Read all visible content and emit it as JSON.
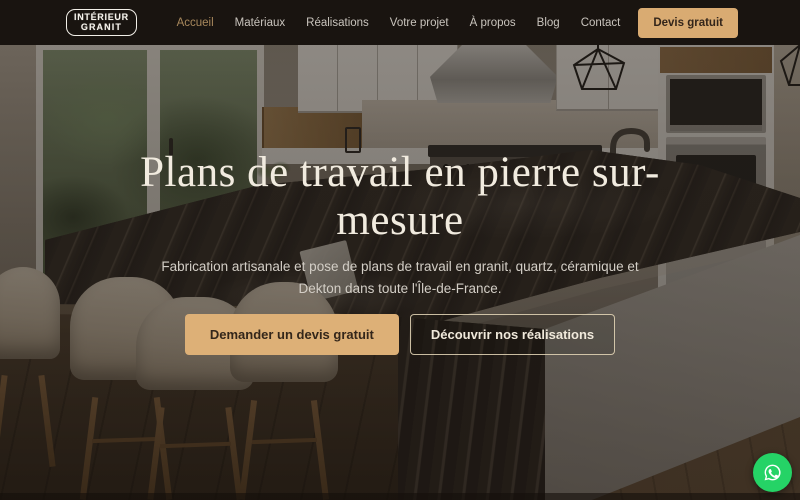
{
  "brand": {
    "name_line1": "INTÉRIEUR",
    "name_line2": "GRANIT"
  },
  "nav": {
    "links": [
      {
        "label": "Accueil",
        "active": true
      },
      {
        "label": "Matériaux",
        "active": false
      },
      {
        "label": "Réalisations",
        "active": false
      },
      {
        "label": "Votre projet",
        "active": false
      },
      {
        "label": "À propos",
        "active": false
      },
      {
        "label": "Blog",
        "active": false
      },
      {
        "label": "Contact",
        "active": false
      }
    ],
    "cta_label": "Devis gratuit"
  },
  "hero": {
    "title_line1": "Plans de travail en pierre sur-",
    "title_line2": "mesure",
    "subtitle": "Fabrication artisanale et pose de plans de travail en granit, quartz, céramique et Dekton dans toute l'Île-de-France.",
    "primary_cta_label": "Demander un devis gratuit",
    "secondary_cta_label": "Découvrir nos réalisations"
  },
  "floating_action": {
    "icon": "whatsapp-icon",
    "color": "#25d366"
  },
  "colors": {
    "accent_tan": "#d9ab72",
    "nav_background": "#191410",
    "headline_cream": "#f1ebdf",
    "whatsapp_green": "#25d366"
  },
  "scene_description": "Kitchen with dark marble island countertop, cream bar stools, glass doors with greenery, white cabinets, range hood, wire pendant lights and built-in ovens"
}
